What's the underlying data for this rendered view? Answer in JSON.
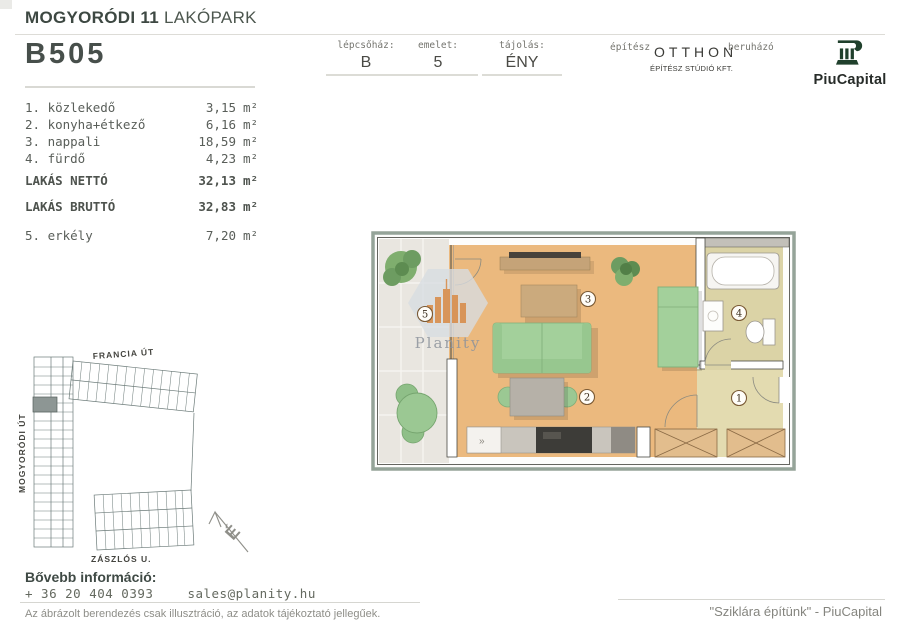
{
  "header": {
    "title_bold": "MOGYORÓDI 11",
    "title_light": "LAKÓPARK",
    "unit_id": "B505",
    "info": [
      {
        "label": "lépcsőház:",
        "value": "B"
      },
      {
        "label": "emelet:",
        "value": "5"
      },
      {
        "label": "tájolás:",
        "value": "ÉNY"
      }
    ],
    "architect": {
      "label": "építész",
      "name": "OTTHON",
      "sub": "ÉPÍTÉSZ STÚDIÓ KFT."
    },
    "developer": {
      "label": "beruházó",
      "name": "PiuCapital"
    }
  },
  "rooms": {
    "unit": "m²",
    "items": [
      {
        "label": "1. közlekedő",
        "area": "3,15"
      },
      {
        "label": "2. konyha+étkező",
        "area": "6,16"
      },
      {
        "label": "3. nappali",
        "area": "18,59"
      },
      {
        "label": "4. fürdő",
        "area": "4,23"
      }
    ],
    "net": {
      "label": "LAKÁS NETTÓ",
      "area": "32,13"
    },
    "gross": {
      "label": "LAKÁS BRUTTÓ",
      "area": "32,83"
    },
    "balcony": {
      "label": "5. erkély",
      "area": "7,20"
    }
  },
  "floorplan": {
    "markers": [
      "1",
      "2",
      "3",
      "4",
      "5"
    ],
    "watermark": "Planity",
    "kitchen_glyph": "»"
  },
  "sitemap": {
    "streets": [
      "FRANCIA ÚT",
      "MOGYORÓDI ÚT",
      "ZÁSZLÓS U."
    ],
    "north": "É"
  },
  "footer": {
    "info_label": "Bővebb információ:",
    "phone": "+ 36 20 404 0393",
    "email": "sales@planity.hu",
    "disclaimer": "Az ábrázolt berendezés csak illusztráció, az adatok tájékoztató jellegűek.",
    "slogan": "\"Sziklára építünk\" - PiuCapital"
  },
  "colors": {
    "brand_green": "#20402c",
    "wall_band": "#95a499",
    "wood_floor": "#ebb97e",
    "bath_floor": "#dbd3a6",
    "balcony_floor": "#e9e6e0",
    "furniture_green": "#a3d09b",
    "marker_brown": "#7a5a35",
    "watermark_orange": "#d88f4f"
  }
}
